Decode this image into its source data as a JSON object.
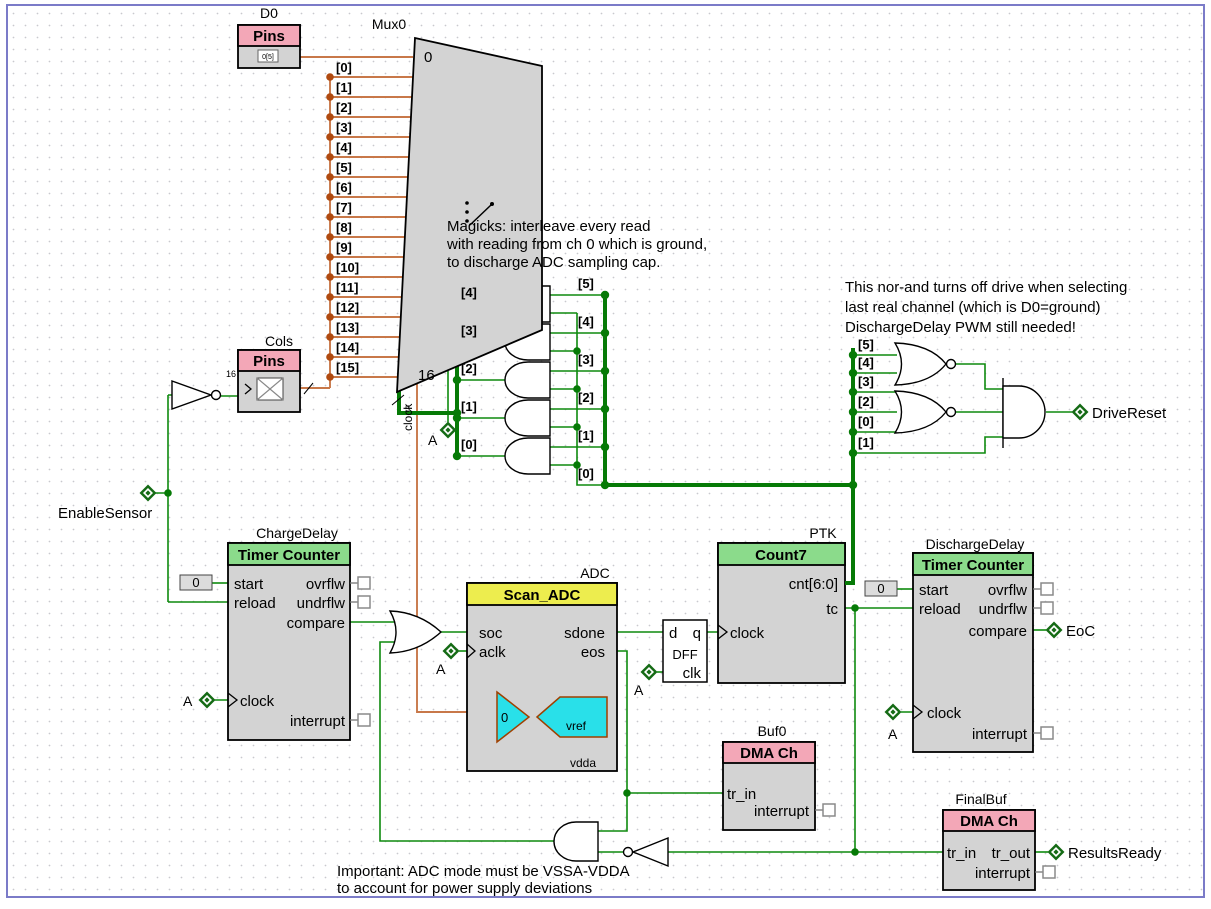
{
  "notes": {
    "m1": "Magicks: interleave every read",
    "m2": "with reading from ch 0 which is ground,",
    "m3": "to discharge ADC sampling cap.",
    "n1": "This nor-and turns off drive when selecting",
    "n2": "last real channel (which is D0=ground)",
    "n3": "DischargeDelay PWM still needed!",
    "i1": "Important: ADC mode must be VSSA-VDDA",
    "i2": "to account for power supply deviations"
  },
  "d0": {
    "name": "D0",
    "type": "Pins",
    "glyph": "0[5]"
  },
  "cols": {
    "name": "Cols",
    "type": "Pins",
    "width": "16"
  },
  "mux": {
    "name": "Mux0",
    "first": "0",
    "last": "16",
    "clock": "clock",
    "sel_width": "5",
    "inputs": [
      "[0]",
      "[1]",
      "[2]",
      "[3]",
      "[4]",
      "[5]",
      "[6]",
      "[7]",
      "[8]",
      "[9]",
      "[10]",
      "[11]",
      "[12]",
      "[13]",
      "[14]",
      "[15]"
    ]
  },
  "and_array": {
    "left": [
      "[4]",
      "[3]",
      "[2]",
      "[1]",
      "[0]"
    ],
    "right": [
      "[5]",
      "[4]",
      "[3]",
      "[2]",
      "[1]",
      "[0]"
    ]
  },
  "nor": {
    "taps": [
      "[5]",
      "[4]",
      "[3]",
      "[2]",
      "[0]",
      "[1]"
    ]
  },
  "charge": {
    "name": "ChargeDelay",
    "type": "Timer Counter",
    "const": "0",
    "pins": {
      "start": "start",
      "reload": "reload",
      "ovrflw": "ovrflw",
      "undrflw": "undrflw",
      "compare": "compare",
      "clock": "clock",
      "interrupt": "interrupt"
    }
  },
  "discharge": {
    "name": "DischargeDelay",
    "type": "Timer Counter",
    "const": "0",
    "pins": {
      "start": "start",
      "reload": "reload",
      "ovrflw": "ovrflw",
      "undrflw": "undrflw",
      "compare": "compare",
      "clock": "clock",
      "interrupt": "interrupt"
    }
  },
  "adc": {
    "name": "ADC",
    "type": "Scan_ADC",
    "zero": "0",
    "vref": "vref",
    "vdda": "vdda",
    "pins": {
      "soc": "soc",
      "aclk": "aclk",
      "sdone": "sdone",
      "eos": "eos"
    }
  },
  "dff": {
    "d": "d",
    "q": "q",
    "name": "DFF",
    "clk": "clk"
  },
  "count7": {
    "name": "PTK",
    "type": "Count7",
    "cnt": "cnt[6:0]",
    "tc": "tc",
    "clock": "clock"
  },
  "buf0": {
    "name": "Buf0",
    "type": "DMA Ch",
    "tr_in": "tr_in",
    "interrupt": "interrupt"
  },
  "finalbuf": {
    "name": "FinalBuf",
    "type": "DMA Ch",
    "tr_in": "tr_in",
    "tr_out": "tr_out",
    "interrupt": "interrupt"
  },
  "terms": {
    "enable": "EnableSensor",
    "drive": "DriveReset",
    "eoc": "EoC",
    "results": "ResultsReady",
    "a": "A"
  },
  "colors": {
    "wire_green": "#0E8A0E",
    "bus_green": "#067A06",
    "wire_orange": "#C87849",
    "bar_green": "#8BDB8B",
    "bar_pink": "#F3A7B7",
    "bar_yellow": "#EDED4E",
    "body_gray": "#D3D3D3",
    "frame": "#7B7BC8",
    "analog_cyan": "#29E0E9"
  }
}
